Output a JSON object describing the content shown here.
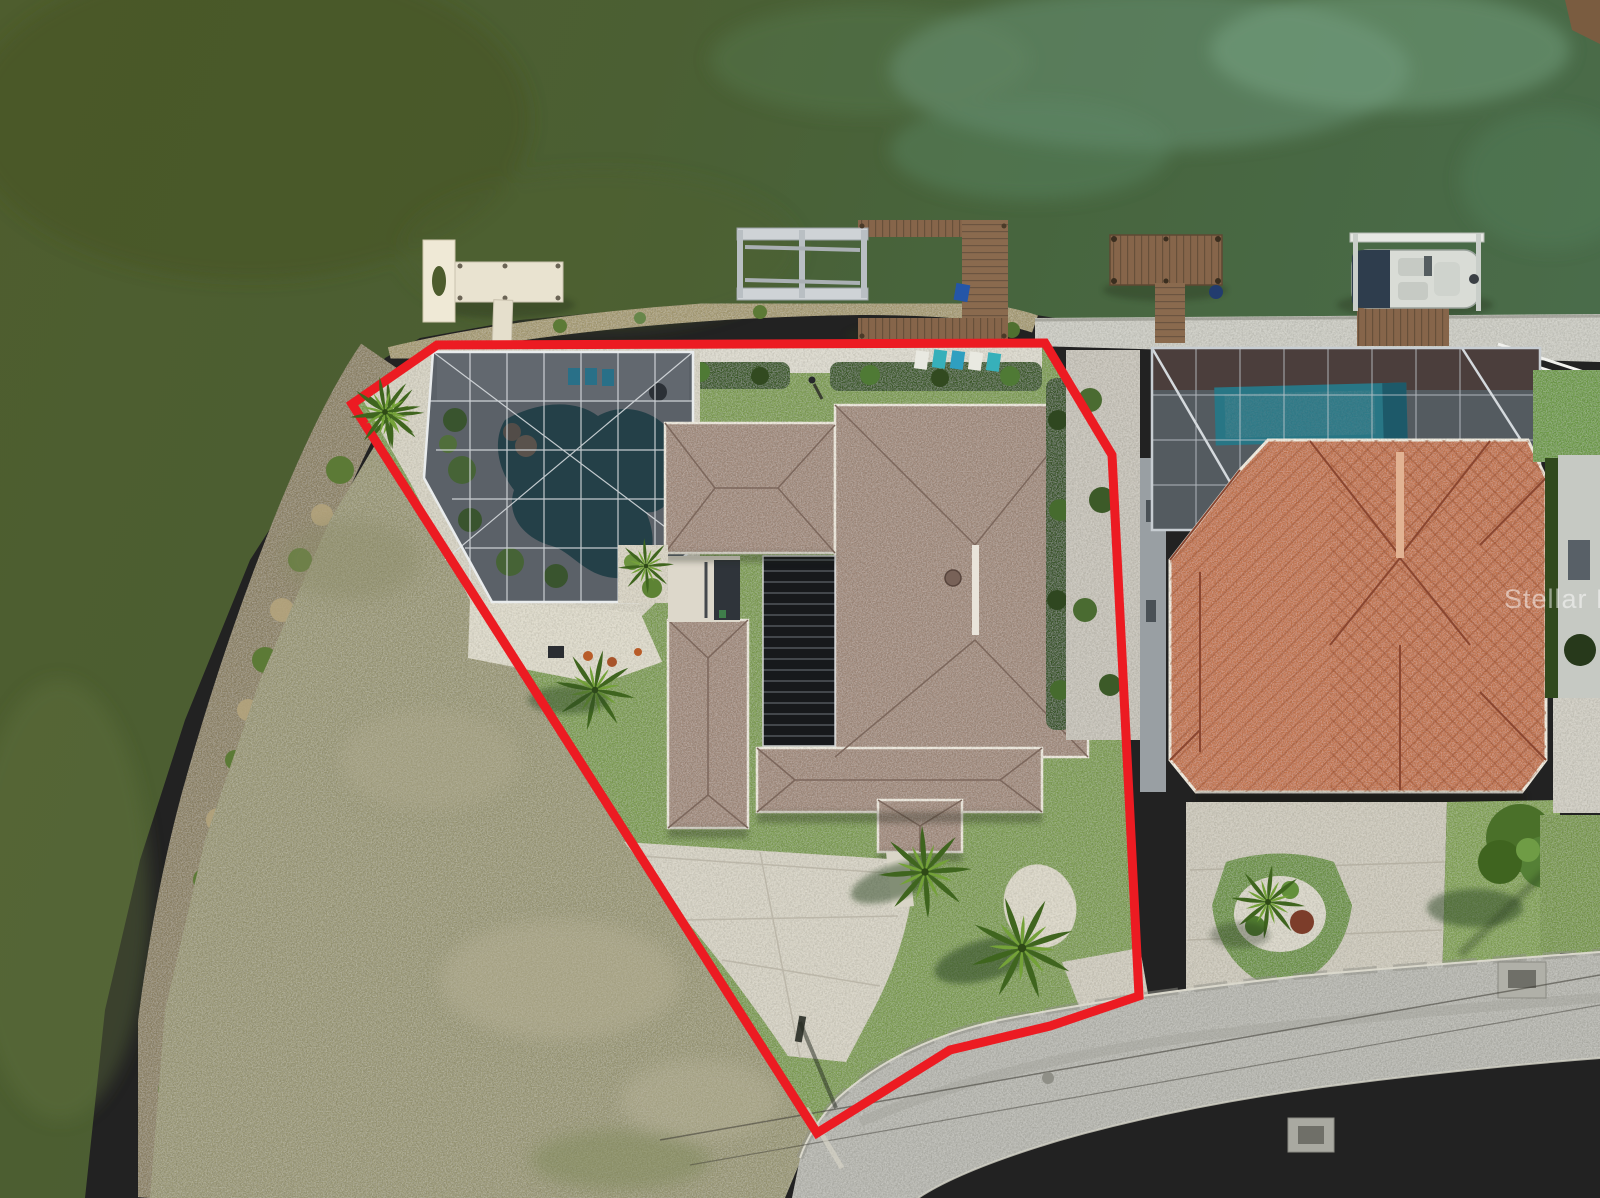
{
  "watermark": {
    "text": "Stellar MLS"
  },
  "colors": {
    "boundary_red": "#ec1b22",
    "water_olive": "#4d5c2d",
    "water_green": "#47684a",
    "pool_subject": "#27525a",
    "pool_neighbor": "#2fb0c4",
    "roof_subject": "#a28b7d",
    "roof_neighbor": "#c4764f",
    "lawn": "#7f9e53",
    "scrub": "#9b9977",
    "road": "#b6b6af",
    "concrete": "#d5d1c3",
    "dock_wood": "#84644a",
    "dock_white": "#ece6d3",
    "screen_mesh": "#20262e"
  }
}
